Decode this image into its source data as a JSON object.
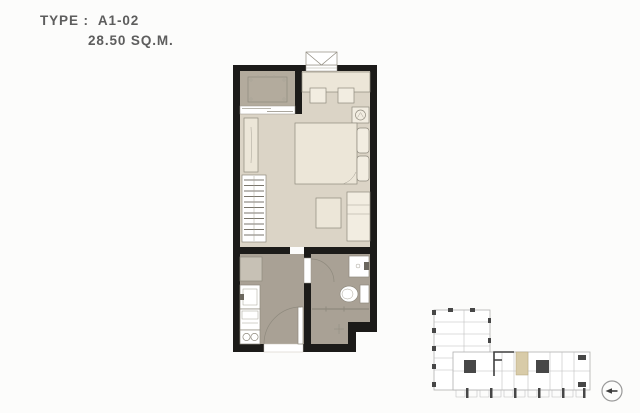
{
  "header": {
    "type_label": "TYPE :",
    "unit_code": "A1-02",
    "area": "28.50 SQ.M."
  },
  "colors": {
    "wall": "#1c1b19",
    "bedroom_floor": "#dbd4c6",
    "balcony_floor": "#b3ab9d",
    "wet_floor": "#a9a195",
    "furniture_fill": "#ece6d8",
    "furniture_light": "#f2ede1",
    "outline": "#8f8a7e",
    "text": "#5d5d5d",
    "highlight_unit": "#d8cba8",
    "keyplan_line": "#b0b0b0",
    "keyplan_dark": "#474747"
  },
  "floor_plan": {
    "symbols": [
      "balcony",
      "ac-condenser-unit",
      "sliding-glass-door",
      "ac-ledge-window",
      "built-in-counter",
      "stool",
      "stool",
      "fan-coil-symbol",
      "double-bed",
      "pillow",
      "pillow",
      "mirror-panel",
      "wardrobe-hanger-rack",
      "side-table",
      "tv-cabinet",
      "refrigerator",
      "kitchen-sink",
      "kitchen-counter",
      "two-burner-stove",
      "entrance-door-swing",
      "bathroom-door-swing",
      "bathroom-sink",
      "toilet",
      "shower-screen",
      "floor-drain"
    ]
  },
  "key_plan": {
    "highlighted_unit": "A1-02"
  },
  "compass": {
    "icon": "north-arrow-icon"
  }
}
